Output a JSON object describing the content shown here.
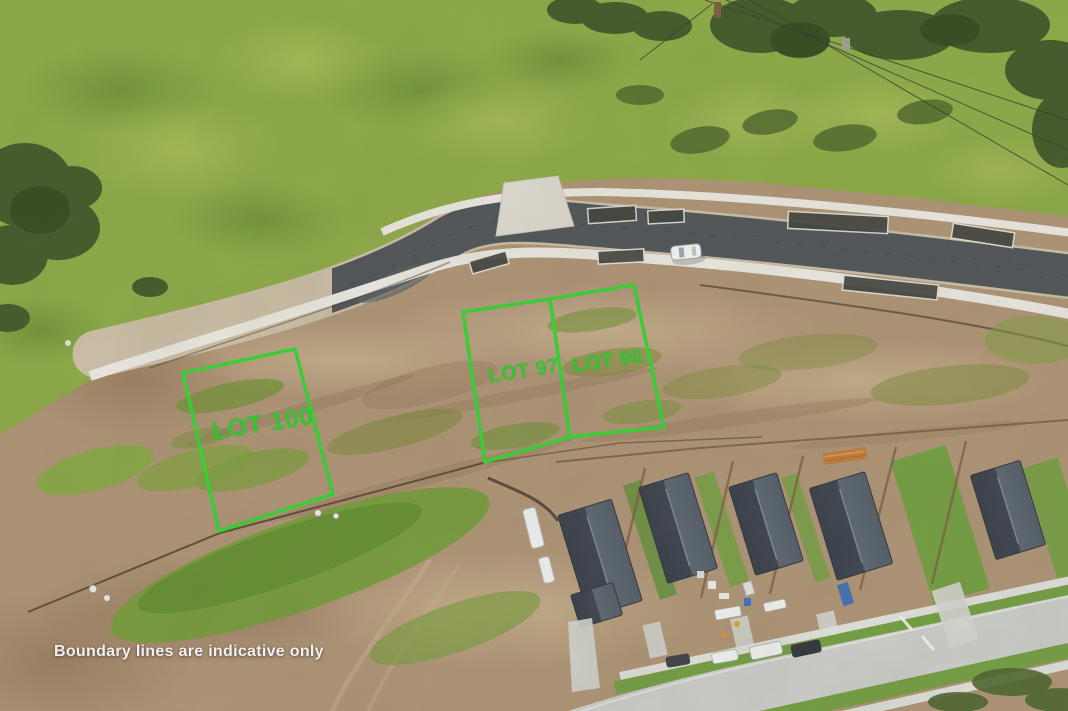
{
  "scene": {
    "type": "aerial-drone-photograph",
    "description": "Aerial view of a new hillside subdivision: grassy paddocks above a freshly built road, three vacant earthworks lots outlined in green, and a row of newly built dark-roofed houses along a suburban street below.",
    "features": [
      "grass hillside paddock",
      "trees and shrubs",
      "power lines",
      "new road with footpaths and rain gardens",
      "parked white car",
      "earthworks building lots",
      "sediment fence",
      "houses under construction",
      "suburban street with parked vehicles"
    ]
  },
  "lots": [
    {
      "label": "LOT 100"
    },
    {
      "label": "LOT 97"
    },
    {
      "label": "LOT 96"
    }
  ],
  "watermark": {
    "text": "Boundary lines are indicative only"
  },
  "colors": {
    "lot_boundary": "#2ed32e",
    "lot_label": "#2fc82f",
    "watermark_text": "#f2f2f2",
    "grass": "#8aa845",
    "dirt": "#ab9173",
    "asphalt": "#4c5156",
    "roof": "#39404b"
  }
}
